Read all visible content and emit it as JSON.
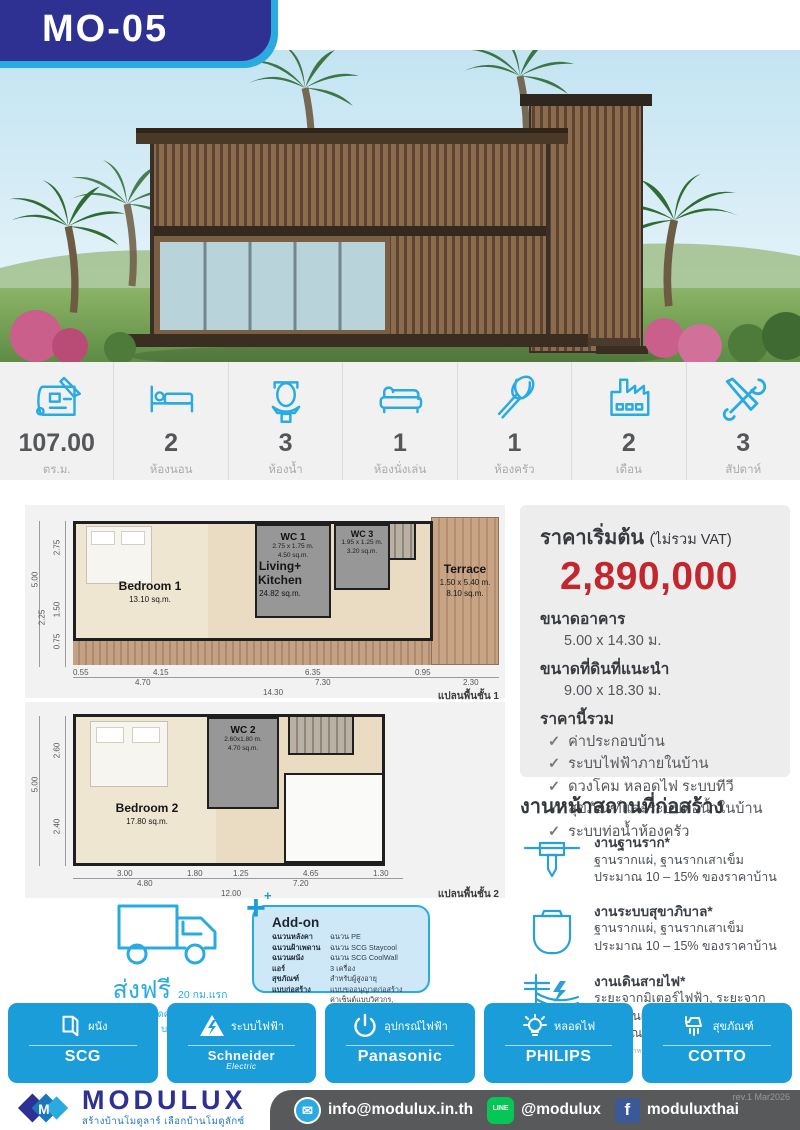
{
  "header": {
    "model": "MO-05"
  },
  "specs": {
    "items": [
      {
        "icon": "blueprint-icon",
        "value": "107.00",
        "label": "ตร.ม."
      },
      {
        "icon": "bed-icon",
        "value": "2",
        "label": "ห้องนอน"
      },
      {
        "icon": "toilet-icon",
        "value": "3",
        "label": "ห้องน้ำ"
      },
      {
        "icon": "sofa-icon",
        "value": "1",
        "label": "ห้องนั่งเล่น"
      },
      {
        "icon": "whisk-icon",
        "value": "1",
        "label": "ห้องครัว"
      },
      {
        "icon": "factory-icon",
        "value": "2",
        "label": "เดือน"
      },
      {
        "icon": "tools-icon",
        "value": "3",
        "label": "สัปดาห์"
      }
    ]
  },
  "fp1": {
    "label": "แปลนพื้นชั้น 1",
    "left_total": "5.00",
    "left": [
      "2.75",
      "1.50",
      "2.25",
      "0.75"
    ],
    "b1": [
      "0.55",
      "4.15",
      "6.35",
      "0.95"
    ],
    "b2": [
      "4.70",
      "7.30",
      "2.30"
    ],
    "b3": "14.30",
    "bedroom": {
      "name": "Bedroom 1",
      "area": "13.10 sq.m."
    },
    "wc1": {
      "name": "WC 1",
      "size": "2.75 x 1.75 m.",
      "area": "4.50 sq.m."
    },
    "wc3": {
      "name": "WC 3",
      "size": "1.95 x 1.25 m.",
      "area": "3.20 sq.m."
    },
    "living": {
      "name": "Living+\nKitchen",
      "area": "24.82 sq.m."
    },
    "terrace": {
      "name": "Terrace",
      "size": "1.50 x 5.40 m.",
      "area": "8.10 sq.m."
    }
  },
  "fp2": {
    "label": "แปลนพื้นชั้น 2",
    "left_total": "5.00",
    "left": [
      "2.60",
      "2.40"
    ],
    "b1": [
      "3.00",
      "1.80",
      "1.25",
      "4.65",
      "1.30"
    ],
    "b2": [
      "4.80",
      "7.20"
    ],
    "b3": "12.00",
    "bedroom": {
      "name": "Bedroom 2",
      "area": "17.80 sq.m."
    },
    "wc2": {
      "name": "WC 2",
      "size": "2.60x1.80 m.",
      "area": "4.70 sq.m."
    }
  },
  "price": {
    "title": "ราคาเริ่มต้น",
    "vat": "(ไม่รวม VAT)",
    "amount": "2,890,000",
    "size_label": "ขนาดอาคาร",
    "size": "5.00 x 14.30 ม.",
    "land_label": "ขนาดที่ดินที่แนะนำ",
    "land": "9.00 x 18.30 ม.",
    "includes_label": "ราคานี้รวม",
    "includes": [
      "ค่าประกอบบ้าน",
      "ระบบไฟฟ้าภายในบ้าน",
      "ดวงโคม หลอดไฟ ระบบทีวี",
      "สุขภัณฑ์และระบบท่อน้ำในบ้าน",
      "ระบบท่อน้ำห้องครัว"
    ]
  },
  "site": {
    "title": "งานหน้าสถานที่ก่อสร้าง",
    "items": [
      {
        "icon": "foundation-icon",
        "title": "งานฐานราก*",
        "desc": "ฐานรากแผ่, ฐานรากเสาเข็ม\nประมาณ 10 – 15% ของราคาบ้าน"
      },
      {
        "icon": "septic-tank-icon",
        "title": "งานระบบสุขาภิบาล*",
        "desc": "ฐานรากแผ่, ฐานรากเสาเข็ม\nประมาณ 10 – 15% ของราคาบ้าน"
      },
      {
        "icon": "power-line-icon",
        "title": "งานเดินสายไฟ*",
        "desc": "ระยะจากมิเตอร์ไฟฟ้า, ระยะจาก\nตู้ไฟบ้านเดิม\nประมาณเมตรละ 200 บาท"
      }
    ],
    "footnote": "*ราคานี้เป็นการประเมินราคาเบื้องต้น สำหรับงานฐานรากและระบบโดยรวม ราคาอาจต่างกัน จากราคาแสดงจากที่ประเมินหน้างาน"
  },
  "delivery": {
    "title": "ส่งฟรี",
    "qualifier": "20 กม.แรก",
    "note": "เกิน 20 กม. คิดค่าขนส่งกม.ละ 25 บาท"
  },
  "addon": {
    "title": "Add-on",
    "rows": [
      {
        "label": "ฉนวนหลังคา",
        "value": "ฉนวน PE"
      },
      {
        "label": "ฉนวนฝ้าเพดาน",
        "value": "ฉนวน SCG Staycool"
      },
      {
        "label": "ฉนวนผนัง",
        "value": "ฉนวน SCG CoolWall"
      },
      {
        "label": "แอร์",
        "value": "3 เครื่อง"
      },
      {
        "label": "สุขภัณฑ์",
        "value": "สำหรับผู้สูงอายุ"
      },
      {
        "label": "แบบก่อสร้าง",
        "value": "แบบขออนุญาตก่อสร้าง\nค่าเซ็นต์แบบวิศวกร, สถาปนิก"
      }
    ]
  },
  "brands": {
    "items": [
      {
        "icon": "wall-icon",
        "category": "ผนัง",
        "name": "SCG"
      },
      {
        "icon": "electric-hazard-icon",
        "category": "ระบบไฟฟ้า",
        "name": "Schneider",
        "sub": "Electric"
      },
      {
        "icon": "power-icon",
        "category": "อุปกรณ์ไฟฟ้า",
        "name": "Panasonic"
      },
      {
        "icon": "bulb-icon",
        "category": "หลอดไฟ",
        "name": "PHILIPS"
      },
      {
        "icon": "shower-icon",
        "category": "สุขภัณฑ์",
        "name": "COTTO"
      }
    ]
  },
  "footer": {
    "brand": "MODULUX",
    "tagline": "สร้างบ้านโมดูลาร์ เลือกบ้านโมดูลักซ์",
    "rev": "rev.1 Mar2026",
    "contacts": [
      {
        "icon": "email-icon",
        "text": "info@modulux.in.th"
      },
      {
        "icon": "line-icon",
        "text": "@modulux"
      },
      {
        "icon": "facebook-icon",
        "text": "moduluxthai"
      }
    ]
  },
  "colors": {
    "accent_blue": "#29abe2",
    "navy": "#2e3192",
    "price_red": "#c1272d",
    "brand_tile": "#1b9dd9",
    "footer_gray": "#58595b"
  }
}
